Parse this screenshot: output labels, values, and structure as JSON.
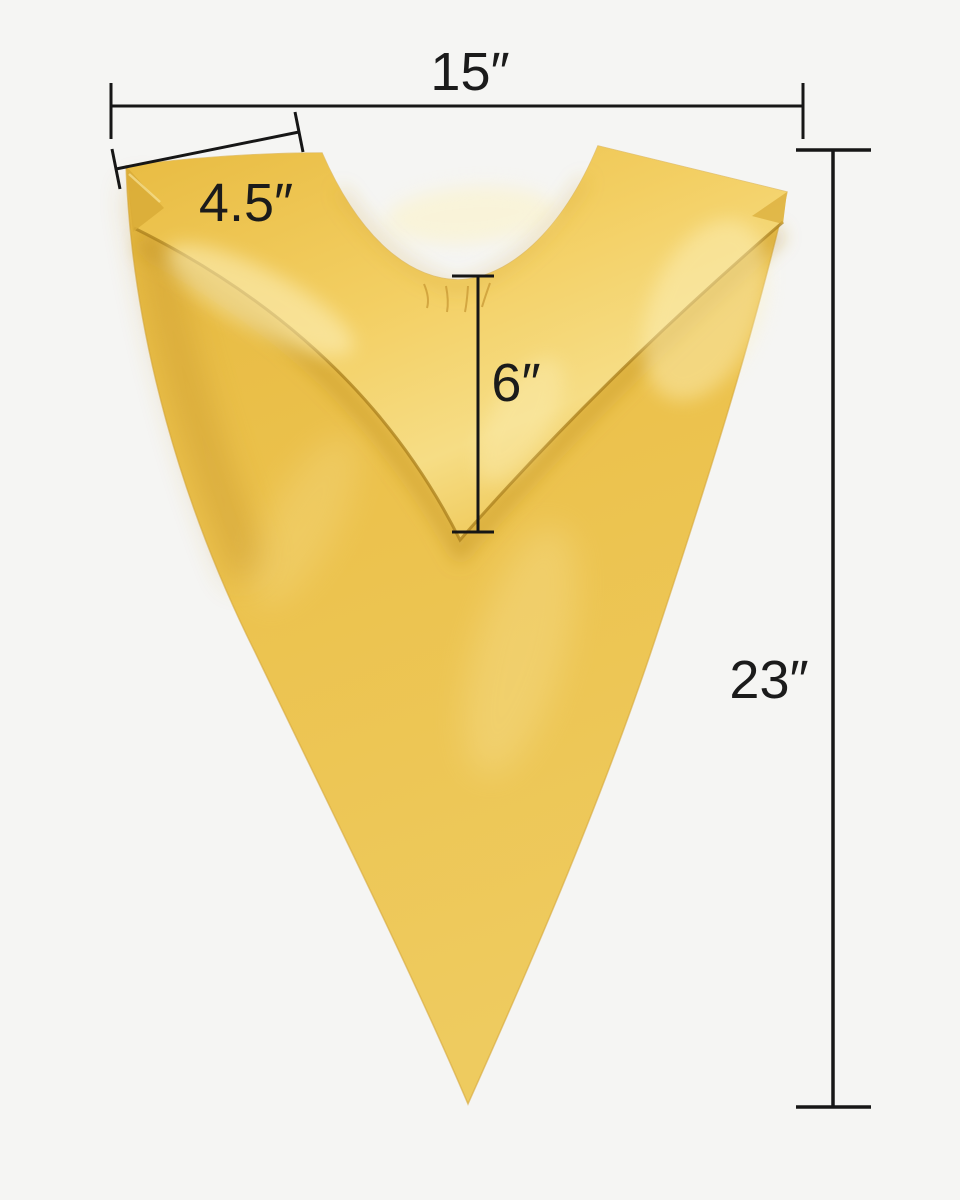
{
  "colors": {
    "background": "#f5f5f3",
    "dimension_line": "#161616",
    "label_text": "#1b1b1b",
    "stole_gold": "#ecc24d",
    "stole_gold_bright": "#f3cf63",
    "stole_gold_deep": "#c2922a",
    "stole_sheen": "#fdf2c0"
  },
  "measurements": {
    "top_width": {
      "label": "15″",
      "inches": 15
    },
    "shoulder_width": {
      "label": "4.5″",
      "inches": 4.5
    },
    "neck_drop": {
      "label": "6″",
      "inches": 6
    },
    "length": {
      "label": "23″",
      "inches": 23
    }
  }
}
